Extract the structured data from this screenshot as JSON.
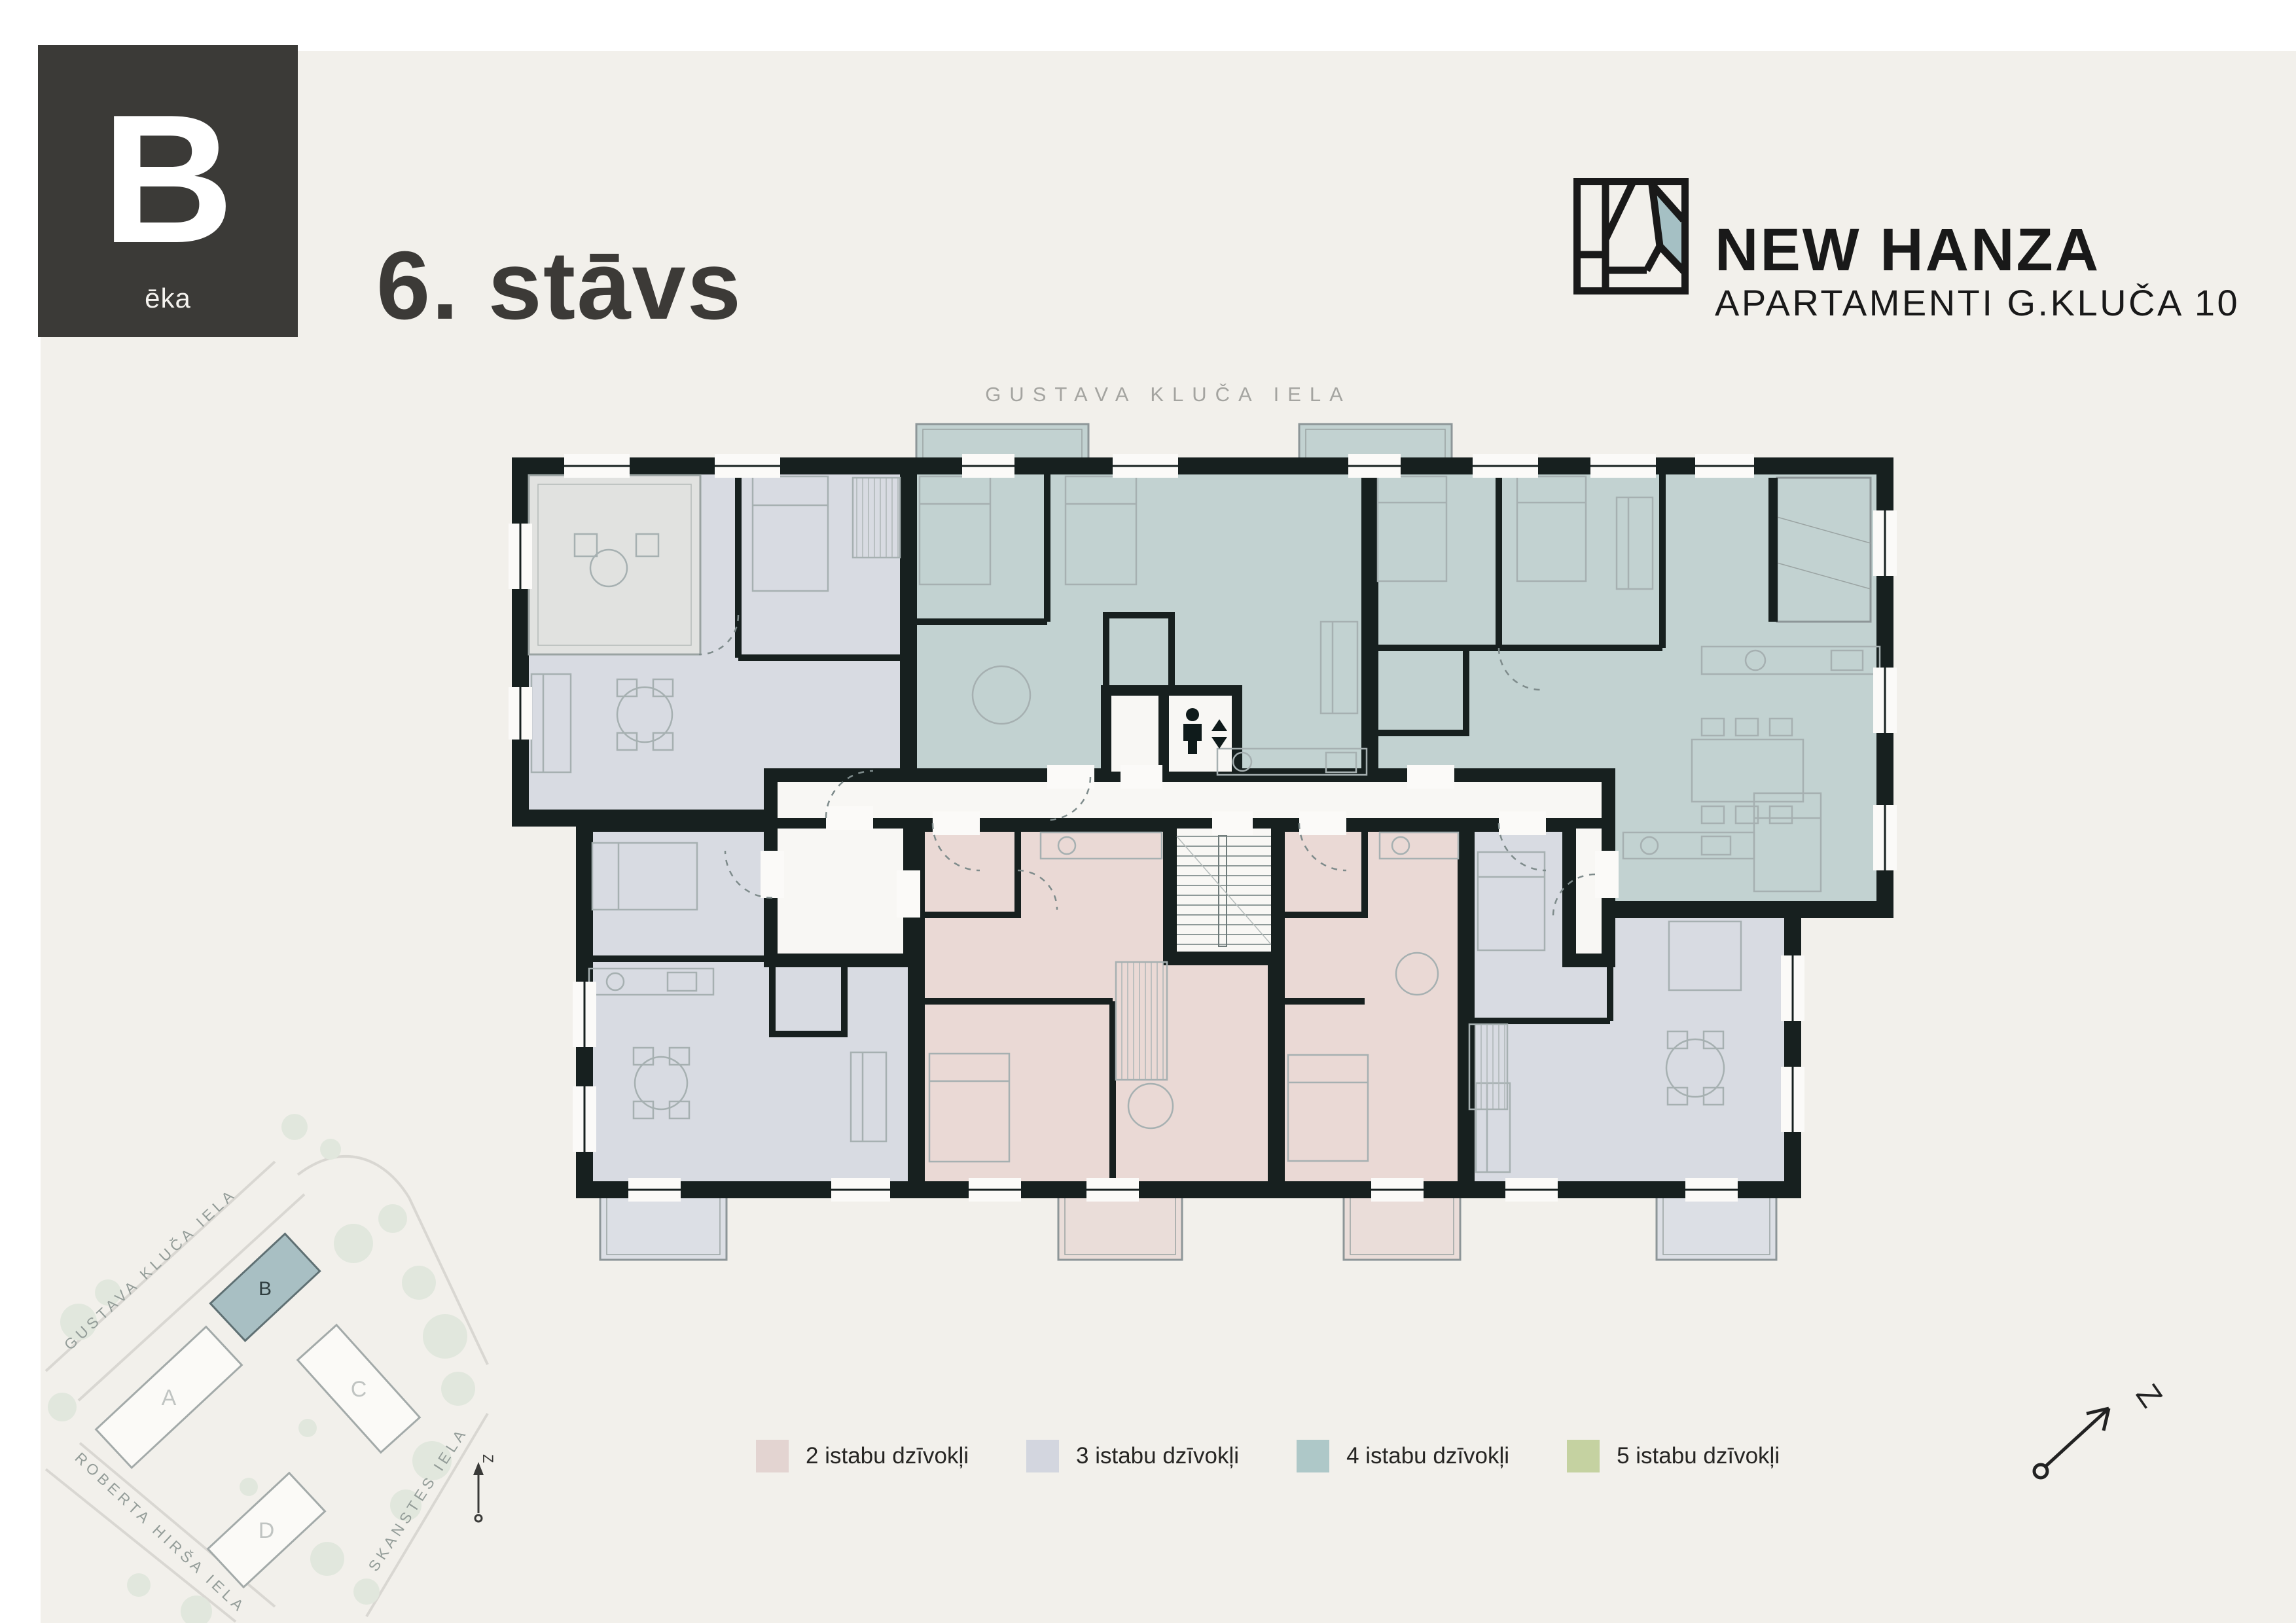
{
  "badge": {
    "letter": "B",
    "sublabel": "ēka"
  },
  "header": {
    "floor_title": "6. stāvs",
    "brand_name": "NEW HANZA",
    "brand_subtitle": "APARTAMENTI G.KLUČA 10"
  },
  "plan": {
    "street_label": "GUSTAVA KLUČA IELA",
    "elevator_icon": "elevator-person-up-down"
  },
  "legend": {
    "items": [
      {
        "label": "2 istabu dzīvokļi",
        "color": "#e3d4d1"
      },
      {
        "label": "3 istabu dzīvokļi",
        "color": "#d3d6df"
      },
      {
        "label": "4 istabu dzīvokļi",
        "color": "#aec8c8"
      },
      {
        "label": "5 istabu dzīvokļi",
        "color": "#c5d2a1"
      }
    ]
  },
  "site_map": {
    "buildings": [
      {
        "label": "A",
        "highlighted": false
      },
      {
        "label": "B",
        "highlighted": true
      },
      {
        "label": "C",
        "highlighted": false
      },
      {
        "label": "D",
        "highlighted": false
      }
    ],
    "streets": [
      "GUSTAVA KLUČA IELA",
      "ROBERTA HIRŠA IELA",
      "SKANSTES IELA"
    ],
    "north_label": "Z"
  },
  "compass": {
    "north_label": "Z"
  },
  "colors": {
    "page_background": "#f2f0eb",
    "badge_background": "#3b3a37",
    "wall": "#17201f",
    "apartment_2_room": "#ead9d5",
    "apartment_3_room": "#d8dbe2",
    "apartment_4_room": "#c2d2d1",
    "apartment_5_room": "#c5d2a1",
    "logo_accent": "#a5c0c4",
    "white_room": "#f8f7f4"
  }
}
